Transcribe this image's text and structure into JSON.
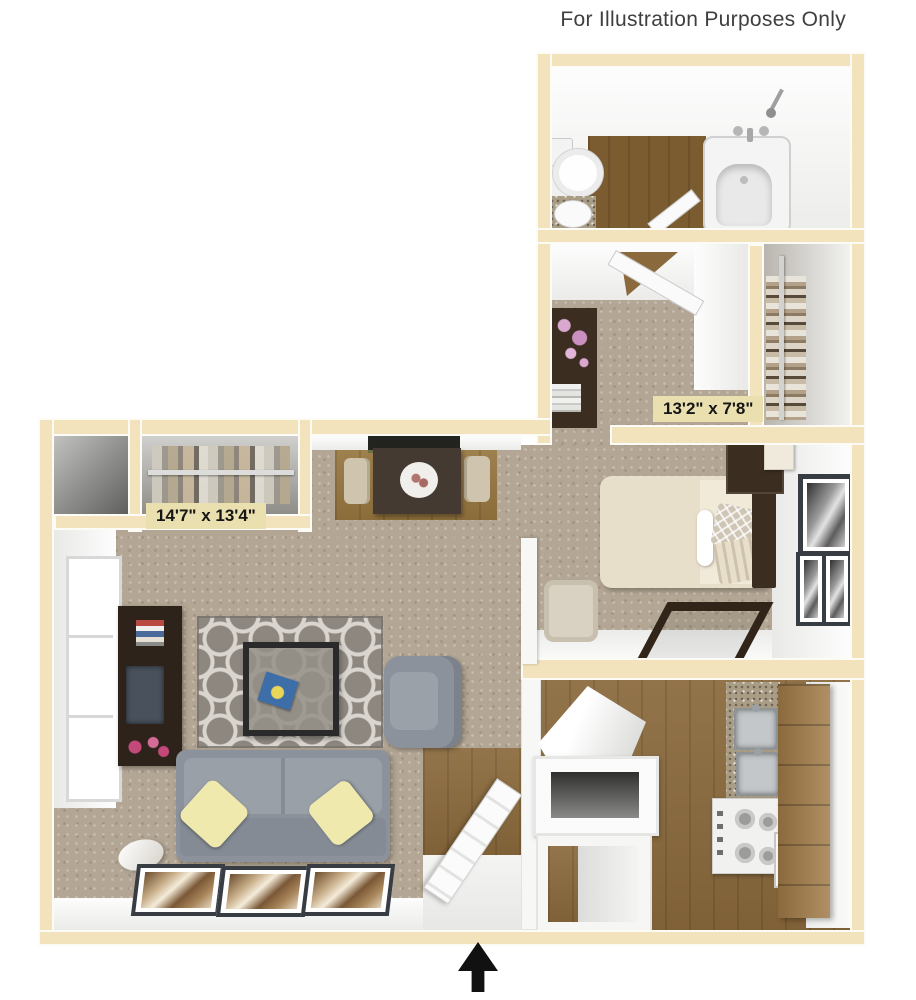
{
  "disclaimer": "For Illustration Purposes Only",
  "labels": {
    "living_dimensions": "14'7\" x 13'4\"",
    "bedroom2_dimensions": "13'2\" x 7'8\""
  },
  "icons": {
    "entry_arrow": "up-arrow-icon"
  },
  "colors": {
    "wall": "#f2e3bc",
    "carpet": "#b3a694",
    "wood": "#8a693c",
    "wood_dark": "#7b5c31",
    "rug_gray": "#8d8780",
    "rug_pattern": "#dad6cf",
    "sofa_gray": "#8b929b",
    "pillow_yellow": "#efe9ae",
    "bed_cream": "#e7dfc9",
    "furniture_dark": "#3b2d20",
    "cabinet_wood": "#a27c48",
    "granite": "#aa9d86",
    "label_bg": "#eadfaf",
    "label_text": "#151515",
    "text": "#3f3f3f"
  }
}
